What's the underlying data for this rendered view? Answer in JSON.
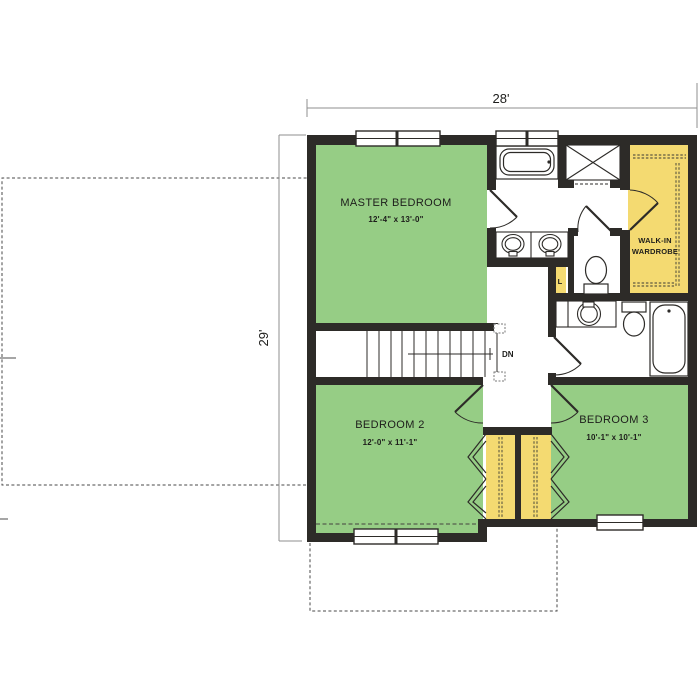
{
  "title": "Second floor plan",
  "dimensions": {
    "overall_width": "28'",
    "overall_height": "29'"
  },
  "rooms": {
    "master_bedroom": {
      "label": "MASTER BEDROOM",
      "dims": "12'-4\" x 13'-0\""
    },
    "bedroom2": {
      "label": "BEDROOM 2",
      "dims": "12'-0\" x 11'-1\""
    },
    "bedroom3": {
      "label": "BEDROOM 3",
      "dims": "10'-1\" x 10'-1\""
    },
    "walkin_wardrobe": {
      "line1": "WALK-IN",
      "line2": "WARDROBE"
    },
    "linen_closet": {
      "label": "L"
    }
  },
  "stairs": {
    "down_label": "DN"
  },
  "colors": {
    "bedroom_fill": "#96cd85",
    "closet_fill": "#f4da71",
    "wall": "#2d2b28",
    "dimension_line": "#8f8f8f",
    "dashed_outline": "#4a4a4a"
  }
}
